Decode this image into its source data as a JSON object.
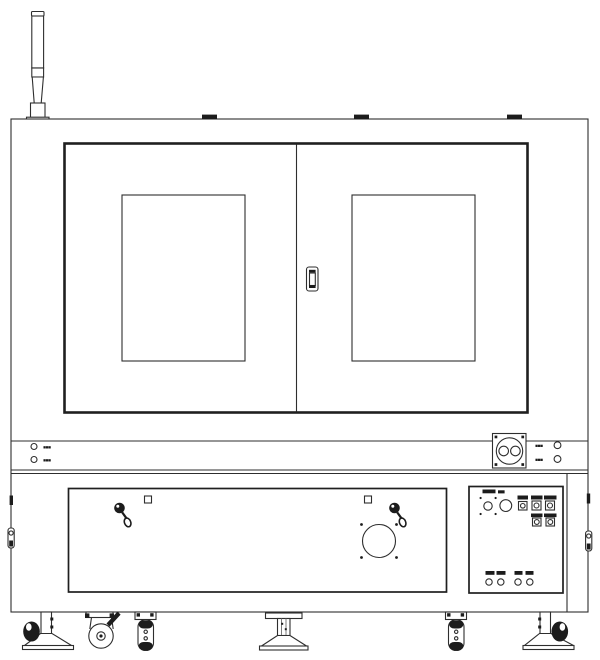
{
  "drawing": {
    "subject": "industrial-machine-front-elevation-line-drawing",
    "colors": {
      "line": "#2e2e2e",
      "line_strong": "#1f1f1f",
      "line_light": "#6e6e6e",
      "fill": "#1c1c1c",
      "background": "#ffffff"
    }
  },
  "band": {
    "left_indicators": [
      {
        "label": "▪▪▪"
      },
      {
        "label": "▪▪▪"
      }
    ],
    "right_indicators": [
      {
        "label": "▪▪▪"
      },
      {
        "label": "▪▪▪"
      }
    ]
  }
}
